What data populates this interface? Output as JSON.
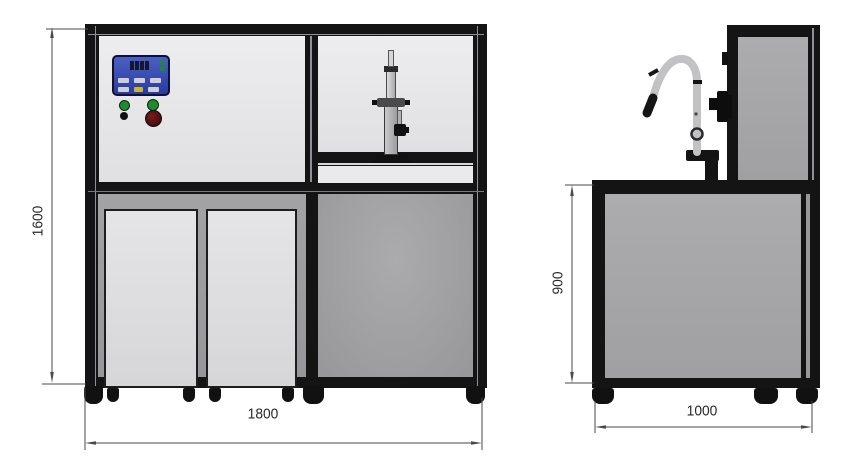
{
  "dimensions": {
    "front_height": "1600",
    "front_width": "1800",
    "side_height": "900",
    "side_depth": "1000"
  },
  "colors": {
    "frame": "#141414",
    "panel_light": "#e4e4e6",
    "panel_medium": "#9b9b9d",
    "panel_side": "#a7a7a9",
    "box": "#dedee0",
    "control_panel_blue": "#3a50b8",
    "indicator_green": "#1f8a2f",
    "indicator_red": "#5a1212",
    "button_yellow": "#c9b43a",
    "dimension_line": "#4a4a4a",
    "faucet": "#c2c2c4"
  }
}
